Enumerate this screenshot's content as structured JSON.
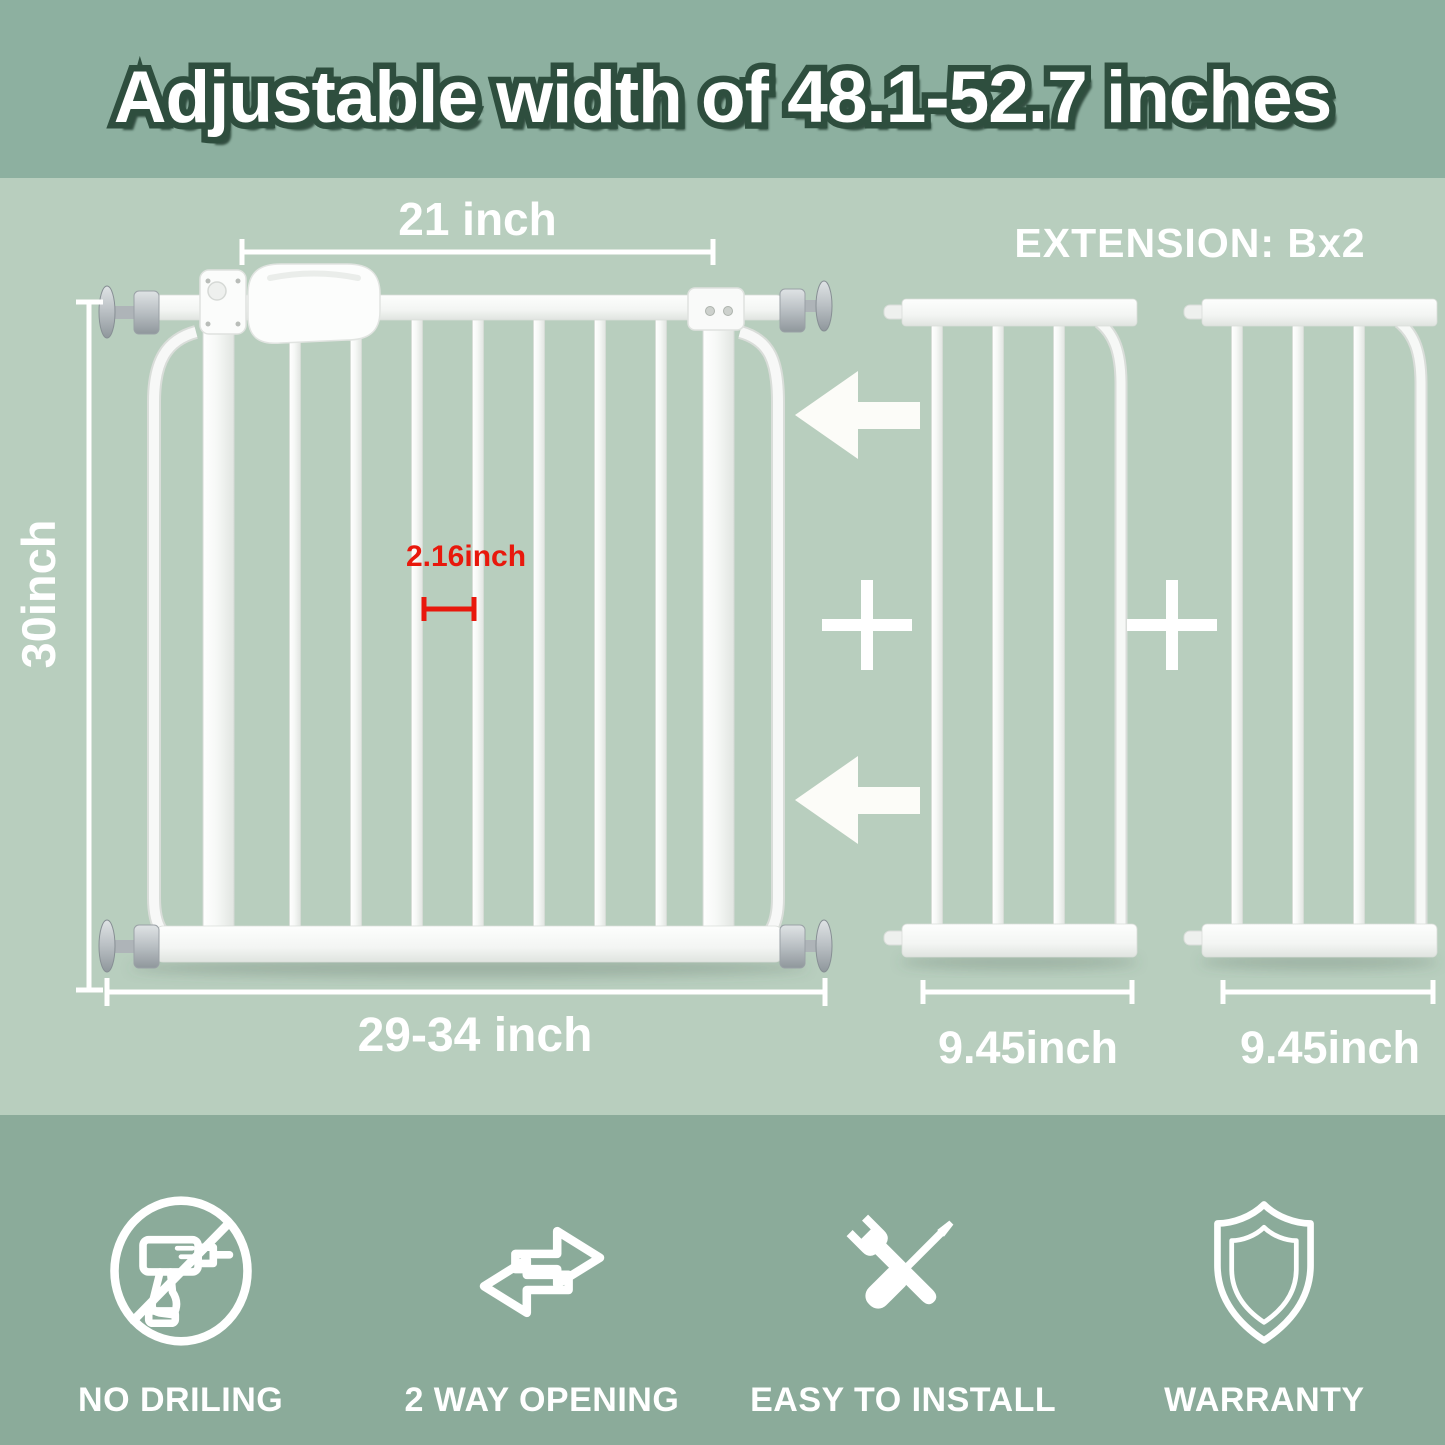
{
  "banner": {
    "title": "Adjustable width of 48.1-52.7 inches"
  },
  "diagram": {
    "extension_label": "EXTENSION: Bx2",
    "gate": {
      "top_width_label": "21 inch",
      "height_label": "30inch",
      "bar_gap_label": "2.16inch",
      "bottom_width_label": "29-34 inch"
    },
    "extensions": [
      {
        "width_label": "9.45inch"
      },
      {
        "width_label": "9.45inch"
      }
    ]
  },
  "features": [
    {
      "icon": "no-drilling-icon",
      "label": "NO DRILING"
    },
    {
      "icon": "two-way-opening-icon",
      "label": "2 WAY OPENING"
    },
    {
      "icon": "tools-icon",
      "label": "EASY TO INSTALL"
    },
    {
      "icon": "shield-icon",
      "label": "WARRANTY"
    }
  ],
  "colors": {
    "banner_bg": "#8db0a0",
    "main_bg": "#b8cebe",
    "footer_bg": "#8bab9a",
    "title_outline": "#2e4e3e",
    "accent_red": "#e8180c",
    "white": "#ffffff"
  }
}
